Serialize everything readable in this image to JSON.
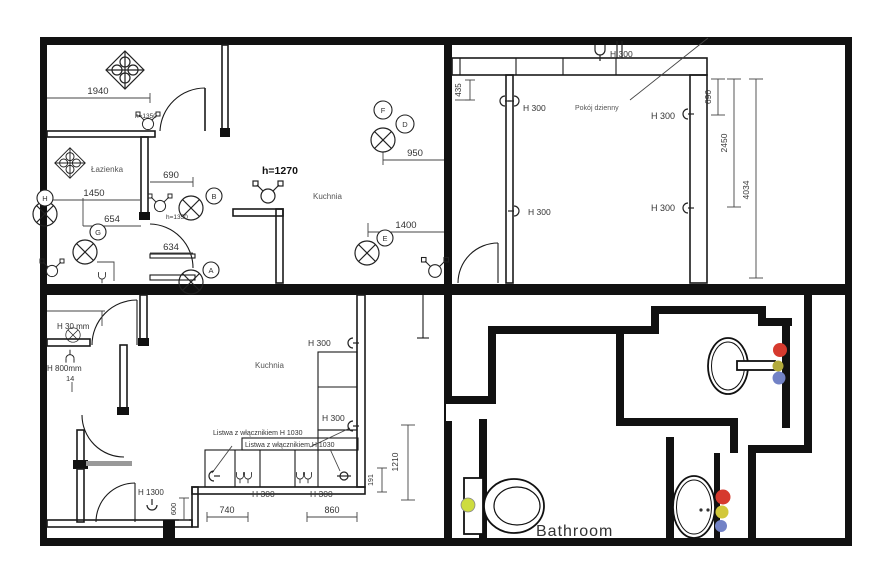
{
  "title": "Apartment electrical floor plans",
  "colors": {
    "red": "#d63a2e",
    "yellow": "#d2c83b",
    "olive": "#b3ab3c",
    "blue": "#7282c6",
    "toilet_dot": "#cddc3f"
  },
  "top_left": {
    "room_bathroom": "Łazienka",
    "room_kitchen": "Kuchnia",
    "height_bold": "h=1270",
    "height_small_1": "h=1350",
    "height_small_2": "h=1350",
    "dim_1940": "1940",
    "dim_690": "690",
    "dim_1450": "1450",
    "dim_654": "654",
    "dim_634": "634",
    "dim_950": "950",
    "dim_1400": "1400",
    "badge_a": "A",
    "badge_b": "B",
    "badge_d": "D",
    "badge_e": "E",
    "badge_f": "F",
    "badge_g": "G",
    "badge_h": "H"
  },
  "top_right": {
    "room": "Pokój dzienny",
    "lamp_label": "H 300",
    "socket_left_top": "H 300",
    "socket_left_mid": "H 300",
    "socket_right_top": "H 300",
    "socket_right_mid": "H 300",
    "dim_435": "435",
    "dim_690": "690",
    "dim_2450": "2450",
    "dim_4034": "4034"
  },
  "bottom_left": {
    "room": "Kuchnia",
    "note_h30": "H 30 mm",
    "note_h800": "H 800mm",
    "note_14": "14",
    "note_h1300": "H 1300",
    "strip_label_1": "Listwa z włącznikiem H 1030",
    "strip_label_2": "Listwa z włącznikiem H 1030",
    "socket_wall_top": "H 300",
    "socket_wall_mid": "H 300",
    "socket_under_1": "H 300",
    "socket_under_2": "H 300",
    "dim_740": "740",
    "dim_860": "860",
    "dim_600": "600",
    "dim_1210": "1210",
    "dim_191": "191"
  },
  "bottom_right": {
    "room": "Bathroom"
  }
}
